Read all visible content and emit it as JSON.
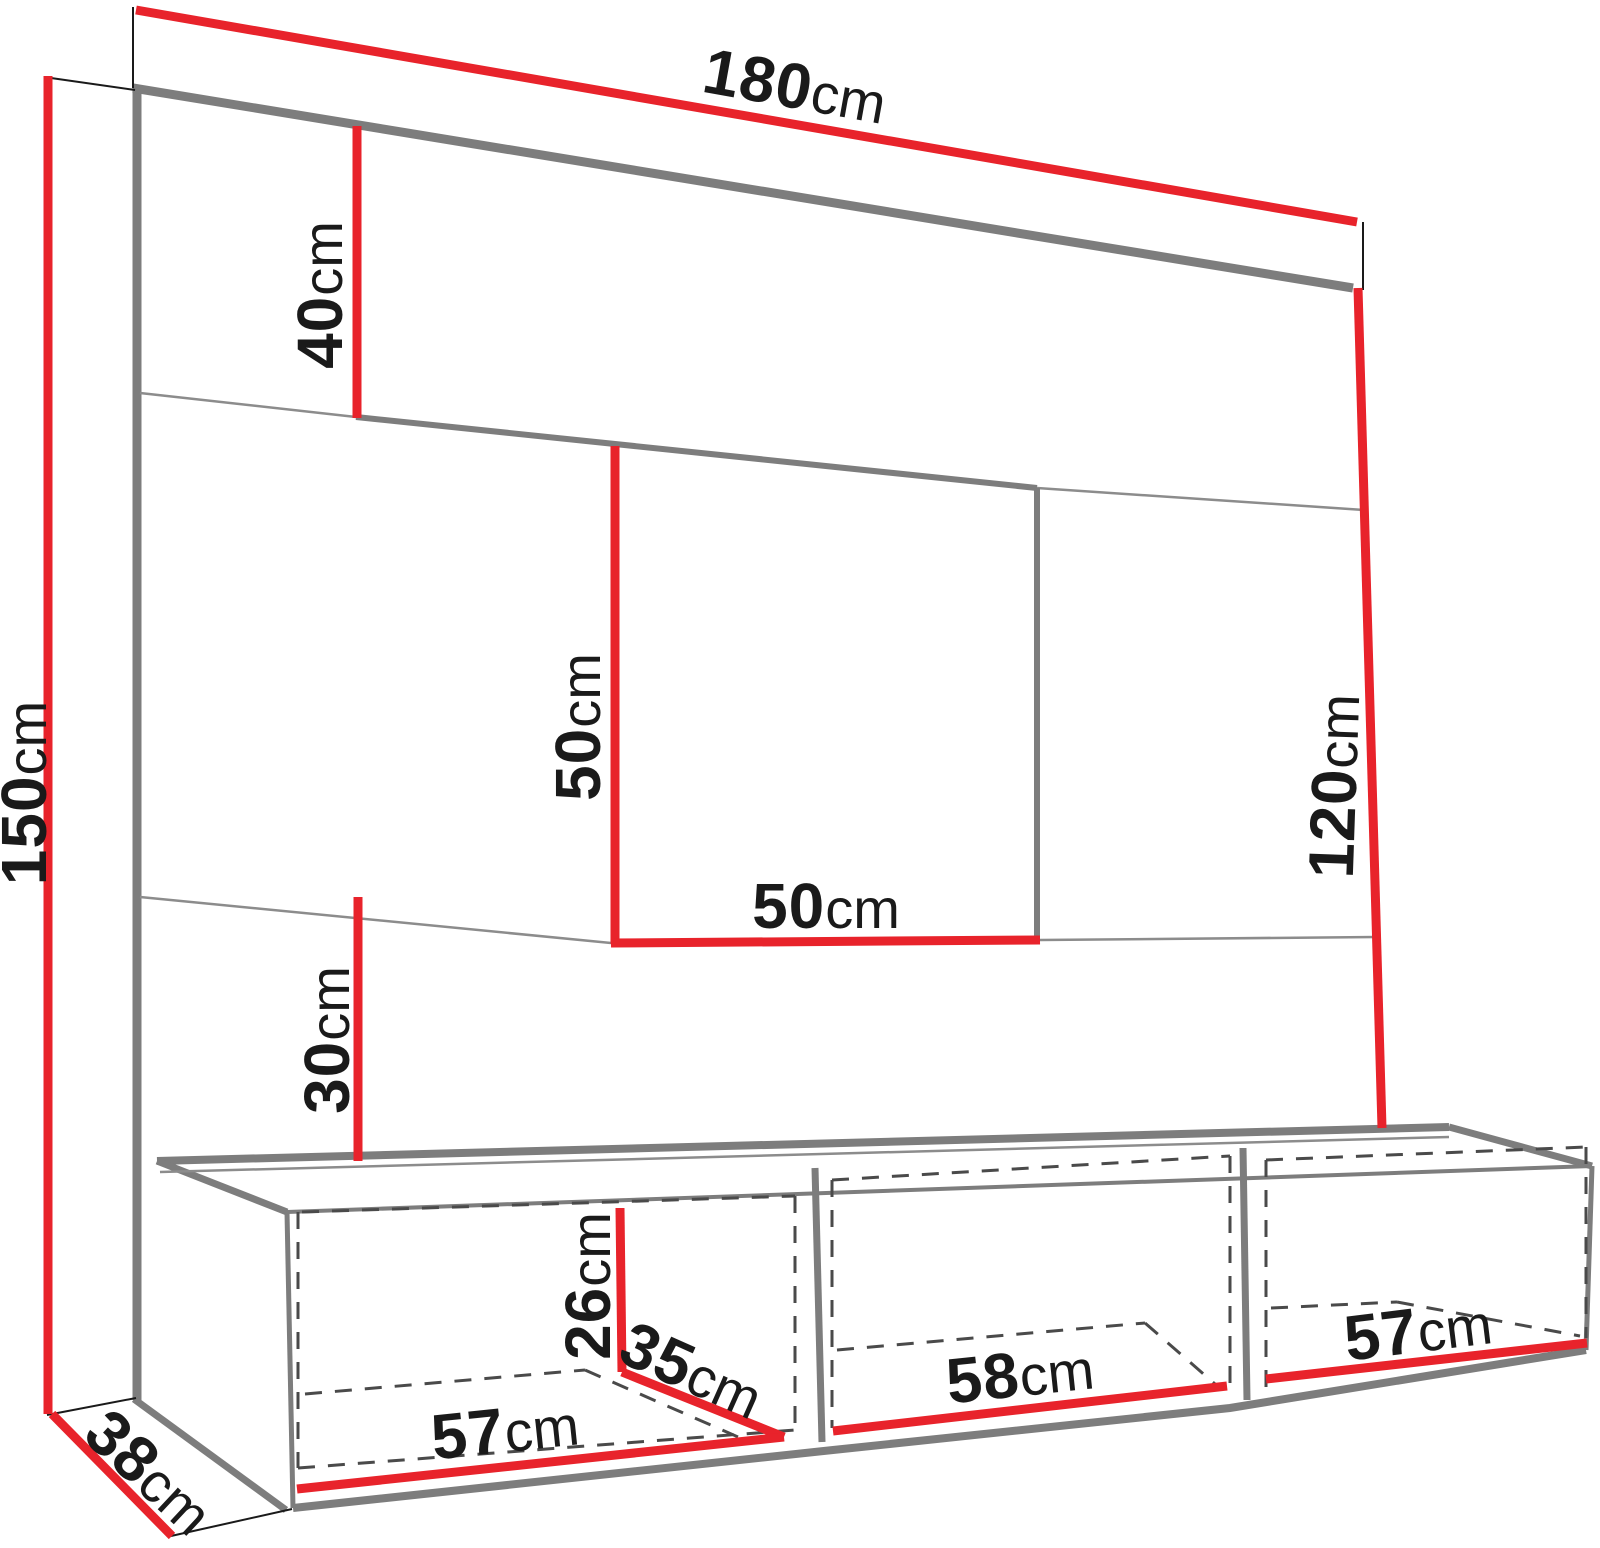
{
  "diagram": {
    "type": "furniture-dimension-drawing",
    "unit": "cm",
    "colors": {
      "dimension_line": "#e8232b",
      "structure_line": "#7d7d7d",
      "text": "#1a1a1a",
      "background": "#ffffff"
    },
    "labels": {
      "total_width": {
        "value": "180",
        "unit": "cm"
      },
      "total_height": {
        "value": "150",
        "unit": "cm"
      },
      "top_section_height": {
        "value": "40",
        "unit": "cm"
      },
      "niche_height": {
        "value": "50",
        "unit": "cm"
      },
      "niche_width": {
        "value": "50",
        "unit": "cm"
      },
      "right_section_height": {
        "value": "120",
        "unit": "cm"
      },
      "lower_section_height": {
        "value": "30",
        "unit": "cm"
      },
      "opening_height": {
        "value": "26",
        "unit": "cm"
      },
      "opening_depth": {
        "value": "35",
        "unit": "cm"
      },
      "left_compartment_width": {
        "value": "57",
        "unit": "cm"
      },
      "middle_compartment_width": {
        "value": "58",
        "unit": "cm"
      },
      "right_compartment_width": {
        "value": "57",
        "unit": "cm"
      },
      "base_depth": {
        "value": "38",
        "unit": "cm"
      }
    }
  }
}
